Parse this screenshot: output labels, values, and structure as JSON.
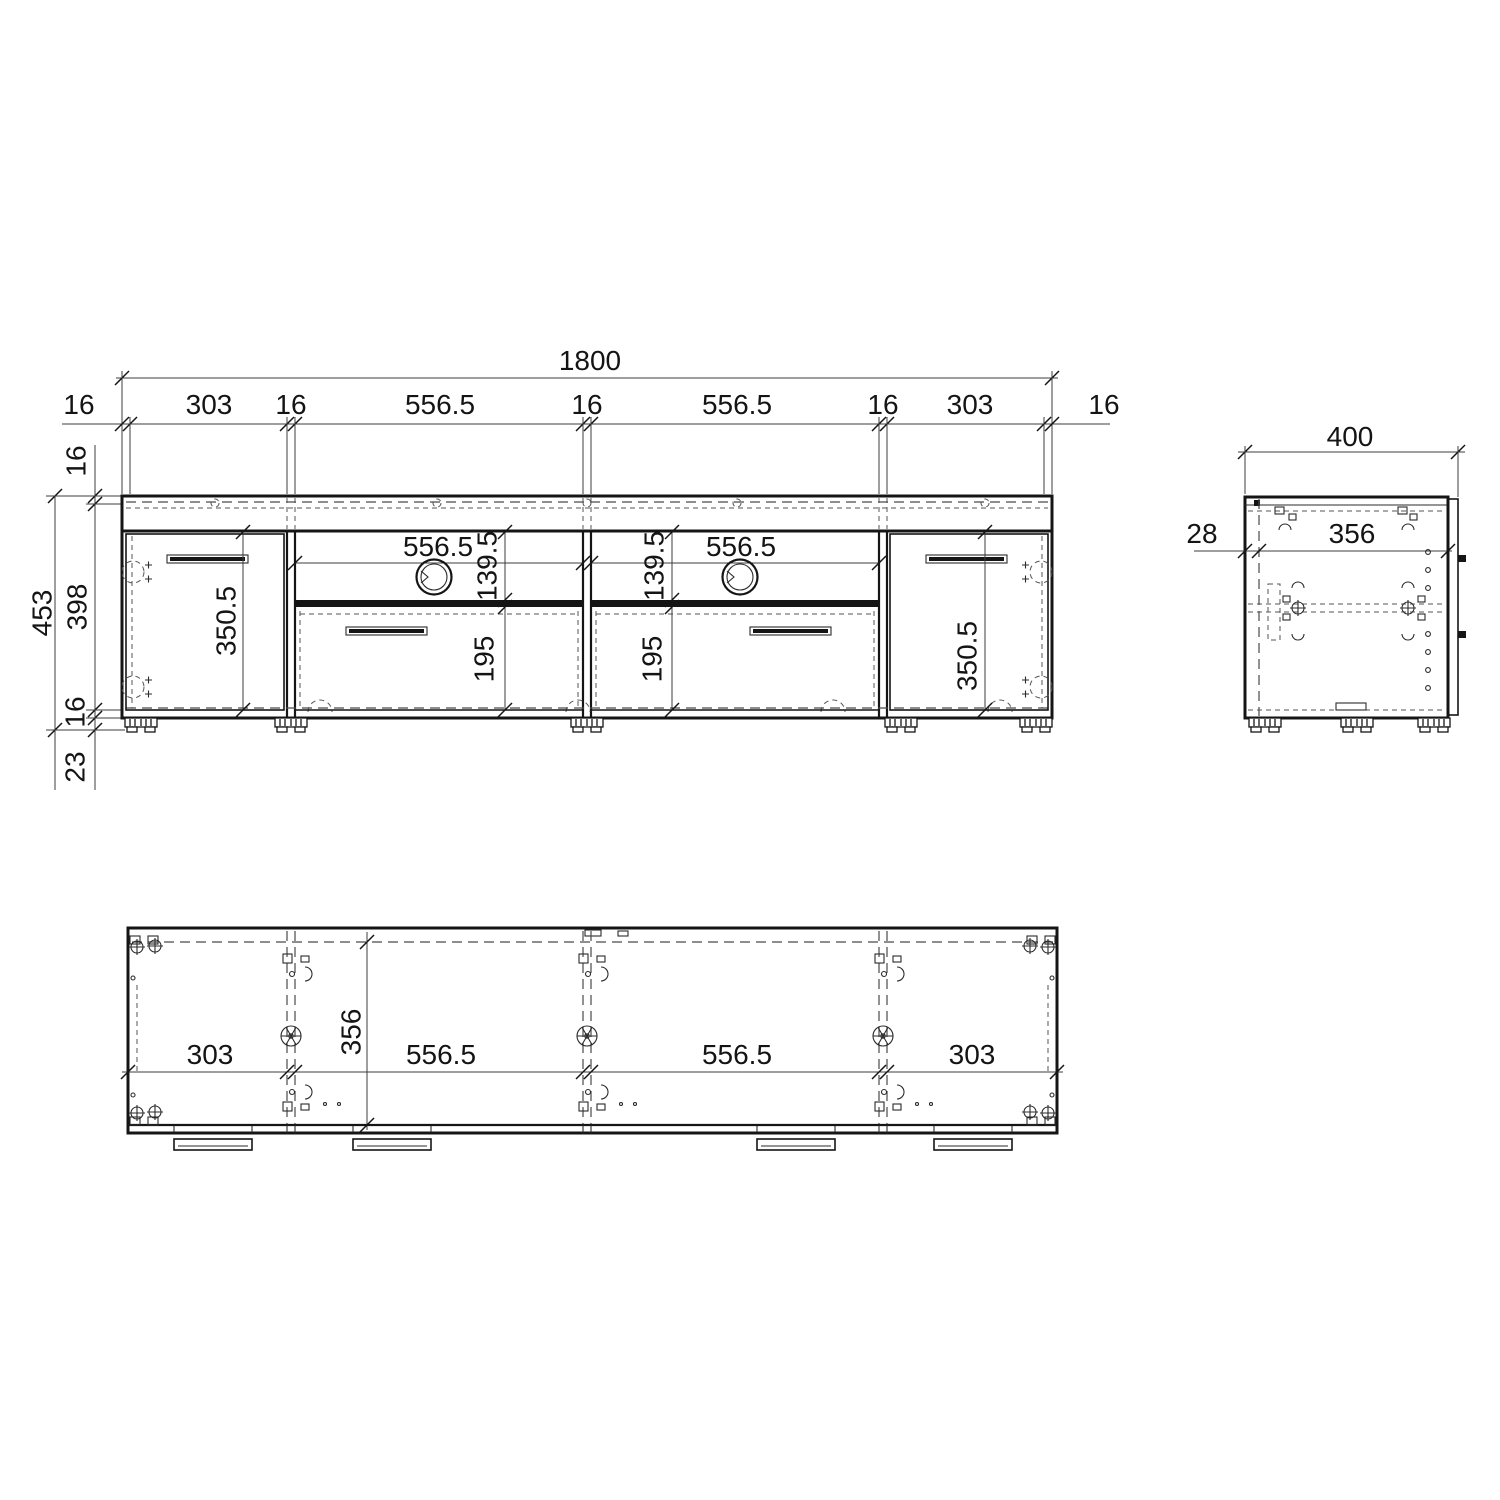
{
  "drawing": {
    "front": {
      "total_width": "1800",
      "chain": [
        "16",
        "303",
        "16",
        "556.5",
        "16",
        "556.5",
        "16",
        "303",
        "16"
      ],
      "height_total": "453",
      "height_interior": "398",
      "top_panel": "16",
      "bottom_panel": "16",
      "feet_height": "23",
      "door_left_height": "350.5",
      "door_right_height": "350.5",
      "niche_left_width": "556.5",
      "niche_right_width": "556.5",
      "niche_left_height": "139.5",
      "niche_right_height": "139.5",
      "drawer_left_height": "195",
      "drawer_right_height": "195"
    },
    "side": {
      "depth": "400",
      "back_offset": "28",
      "interior_depth": "356"
    },
    "plan": {
      "chain": [
        "303",
        "556.5",
        "556.5",
        "303"
      ],
      "interior_depth": "356"
    }
  }
}
